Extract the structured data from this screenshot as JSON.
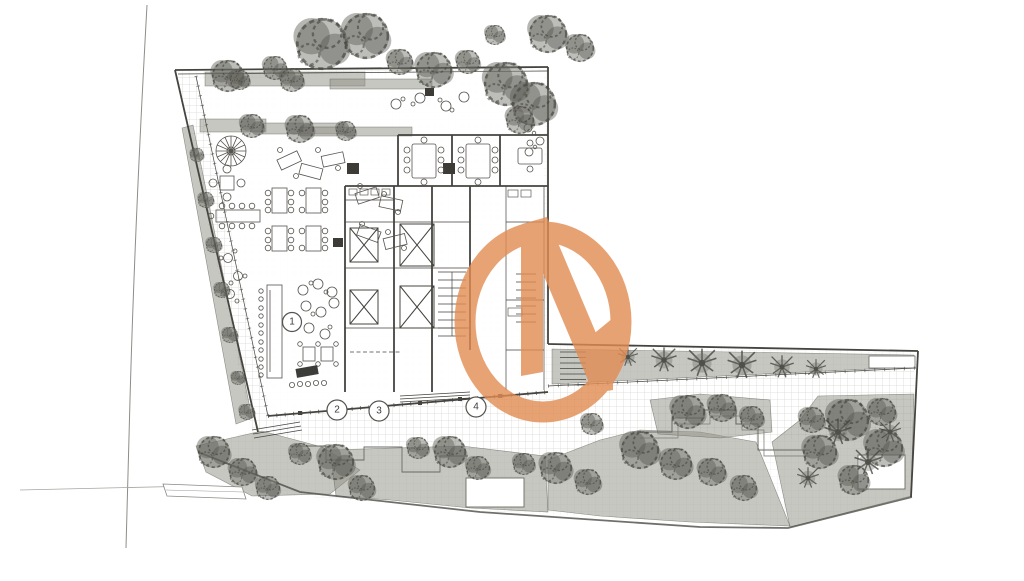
{
  "canvas": {
    "width": 1024,
    "height": 581,
    "background": "#ffffff"
  },
  "plan": {
    "kind": "architectural-ground-floor-site-plan",
    "markers": [
      {
        "label": "1"
      },
      {
        "label": "2"
      },
      {
        "label": "3"
      },
      {
        "label": "4"
      }
    ],
    "colors": {
      "logo_orange": "#e28c52",
      "linework": "#4a4a44",
      "vegetation": "#6f6f68",
      "planter_dark": "#8f8f86",
      "grid": "#ccccc5",
      "paper": "#ffffff"
    },
    "watermark": {
      "icon": "circle-n-logo",
      "opacity": 0.8
    }
  }
}
